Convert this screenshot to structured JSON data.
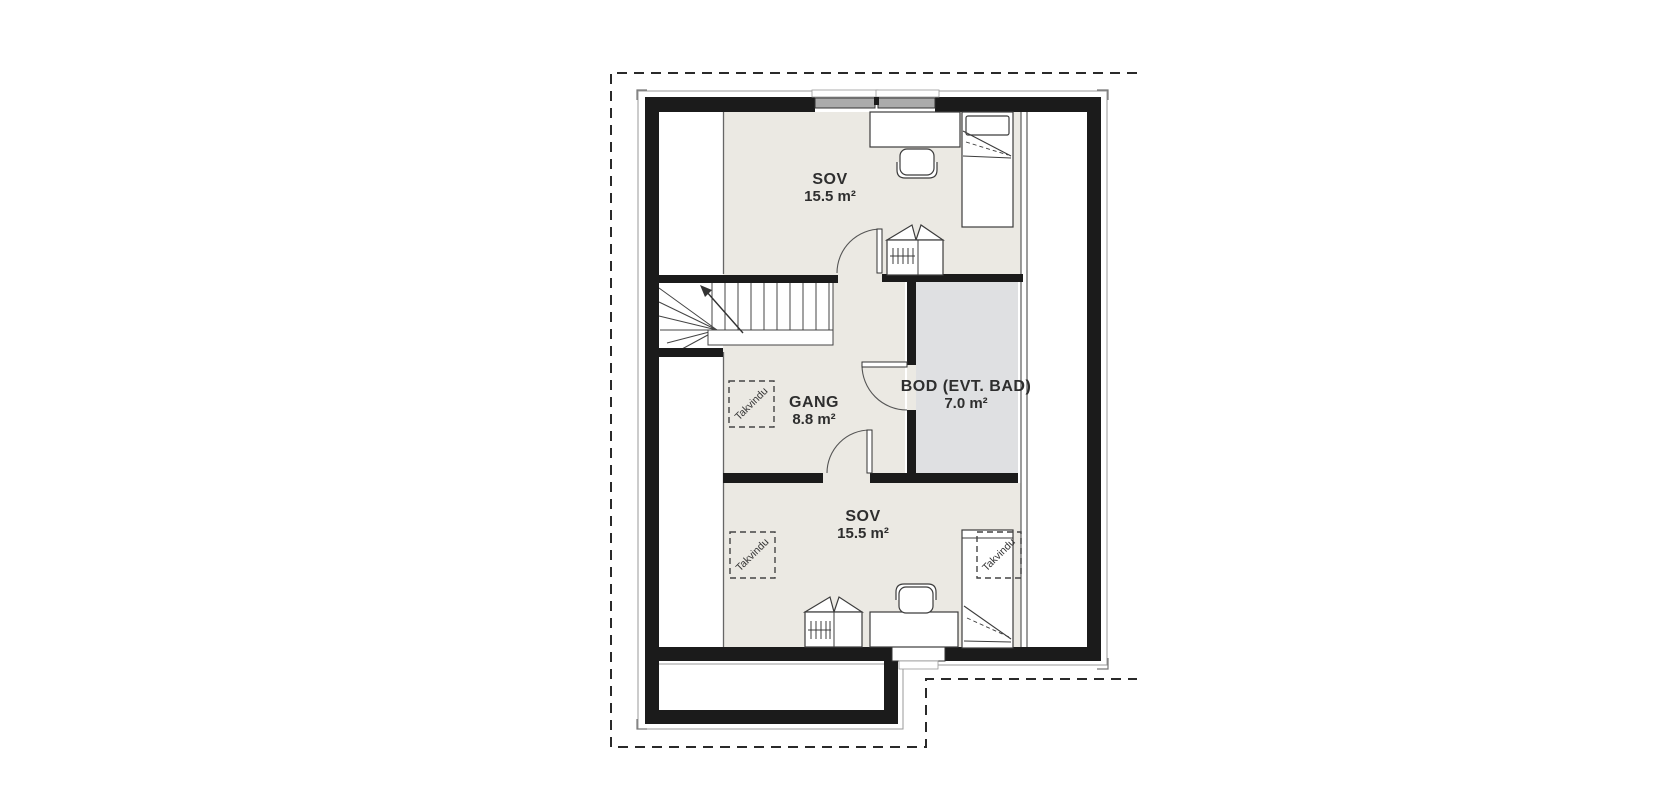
{
  "floorplan": {
    "rooms": [
      {
        "name": "SOV",
        "area": "15.5 m²"
      },
      {
        "name": "GANG",
        "area": "8.8 m²"
      },
      {
        "name": "BOD (EVT. BAD)",
        "area": "7.0 m²"
      },
      {
        "name": "SOV",
        "area": "15.5 m²"
      }
    ],
    "skylights": [
      {
        "label": "Takvindu"
      },
      {
        "label": "Takvindu"
      },
      {
        "label": "Takvindu"
      }
    ],
    "colors": {
      "room_fill": "#EBE9E3",
      "storage_fill": "#DFE0E2",
      "wall": "#1B1B1B",
      "background": "#FFFFFF",
      "furniture_stroke": "#3C3C3C"
    }
  }
}
